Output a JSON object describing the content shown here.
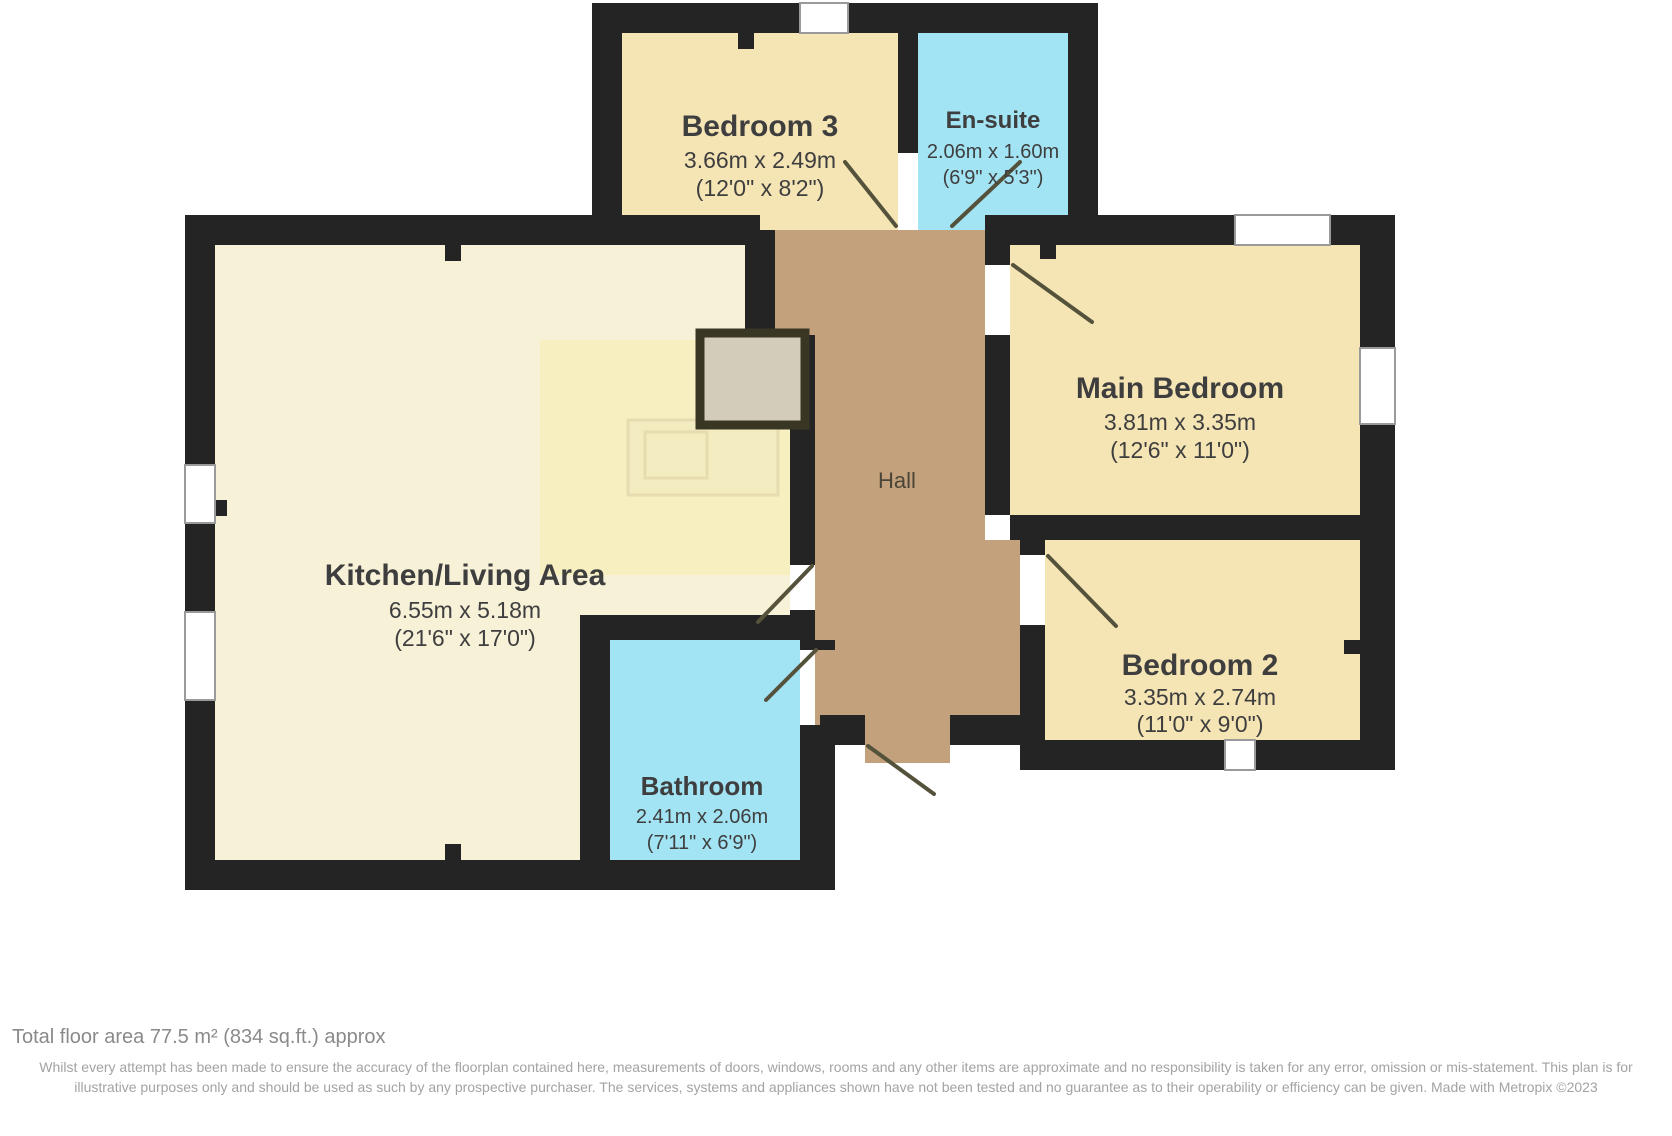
{
  "plan": {
    "rooms": {
      "bedroom3": {
        "name": "Bedroom 3",
        "dim_m": "3.66m x 2.49m",
        "dim_ft": "(12'0\" x 8'2\")"
      },
      "ensuite": {
        "name": "En-suite",
        "dim_m": "2.06m x 1.60m",
        "dim_ft": "(6'9\" x 5'3\")"
      },
      "kitchen_living": {
        "name": "Kitchen/Living Area",
        "dim_m": "6.55m x 5.18m",
        "dim_ft": "(21'6\" x 17'0\")"
      },
      "hall": {
        "name": "Hall"
      },
      "main_bedroom": {
        "name": "Main Bedroom",
        "dim_m": "3.81m x 3.35m",
        "dim_ft": "(12'6\" x 11'0\")"
      },
      "bedroom2": {
        "name": "Bedroom 2",
        "dim_m": "3.35m x 2.74m",
        "dim_ft": "(11'0\" x 9'0\")"
      },
      "bathroom": {
        "name": "Bathroom",
        "dim_m": "2.41m x 2.06m",
        "dim_ft": "(7'11\" x 6'9\")"
      }
    },
    "colors": {
      "bedroom_fill": "#f5e5b5",
      "living_fill": "#f7f1d8",
      "kitchen_zone_fill": "#f7efc0",
      "wet_room_fill": "#a3e4f4",
      "hall_fill": "#c3a17c",
      "wall": "#242424",
      "closet_fill": "#d3ccba"
    }
  },
  "footer": {
    "total_area": "Total floor area 77.5 m² (834 sq.ft.) approx",
    "disclaimer": "Whilst every attempt has been made to ensure the accuracy of the floorplan contained here, measurements of doors, windows, rooms and any other items are approximate and no responsibility is taken for any error, omission or mis-statement. This plan is for illustrative purposes only and should be used as such by any prospective purchaser. The services, systems and appliances shown have not been tested and no guarantee as to their operability or efficiency can be given. Made with Metropix ©2023"
  }
}
